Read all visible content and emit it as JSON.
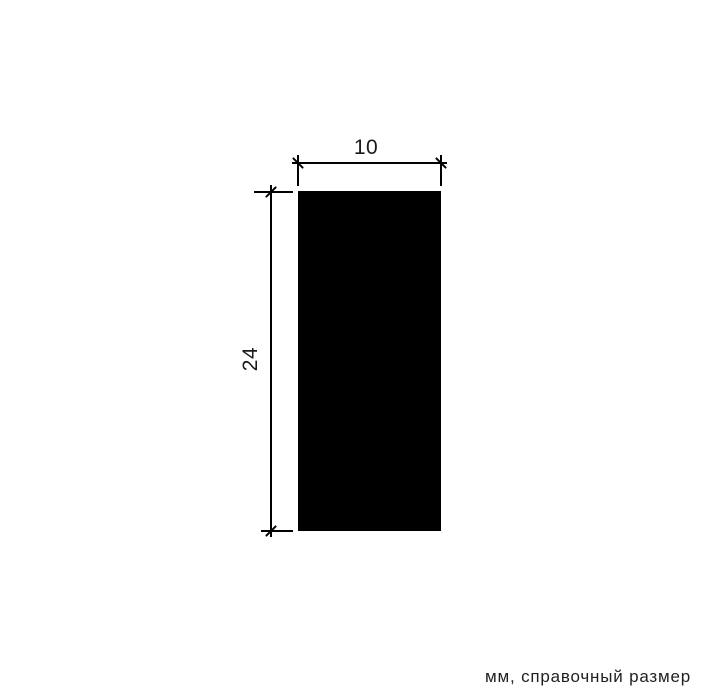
{
  "diagram": {
    "shape": "rectangle",
    "dimensions": {
      "width": {
        "value": "10",
        "orientation": "horizontal"
      },
      "height": {
        "value": "24",
        "orientation": "vertical"
      }
    },
    "units_note": "мм, справочный размер",
    "colors": {
      "line": "#000000",
      "fill": "#000000",
      "text": "#1a1a1a",
      "background": "#ffffff"
    }
  }
}
